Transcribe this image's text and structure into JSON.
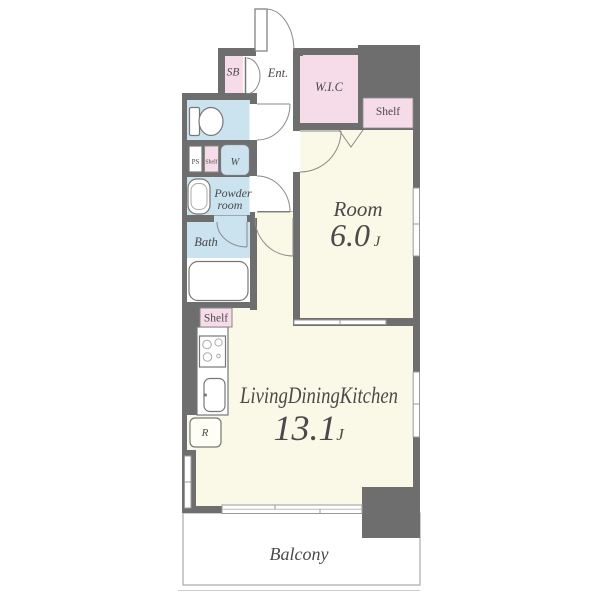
{
  "fp": {
    "title": "apartment-floor-plan",
    "labels": {
      "sb": "SB",
      "ent": "Ent.",
      "wic": "W.I.C",
      "shelf_top": "Shelf",
      "room_name": "Room",
      "room_size": "6.0",
      "room_unit": "J",
      "ps": "PS",
      "shelf_mini": "Shelf",
      "washer": "W",
      "powder1": "Powder",
      "powder2": "room",
      "bath": "Bath",
      "shelf_kitchen": "Shelf",
      "ldk_name": "LivingDiningKitchen",
      "ldk_size": "13.1",
      "ldk_unit": "J",
      "fridge": "R",
      "balcony": "Balcony"
    },
    "colors": {
      "wall": "#6e6e6e",
      "room_cream": "#FAF8E6",
      "wet_area_blue": "#CBE2EF",
      "storage_pink": "#F6DCE8",
      "outline": "#999999",
      "text": "#4a4a4a"
    }
  }
}
